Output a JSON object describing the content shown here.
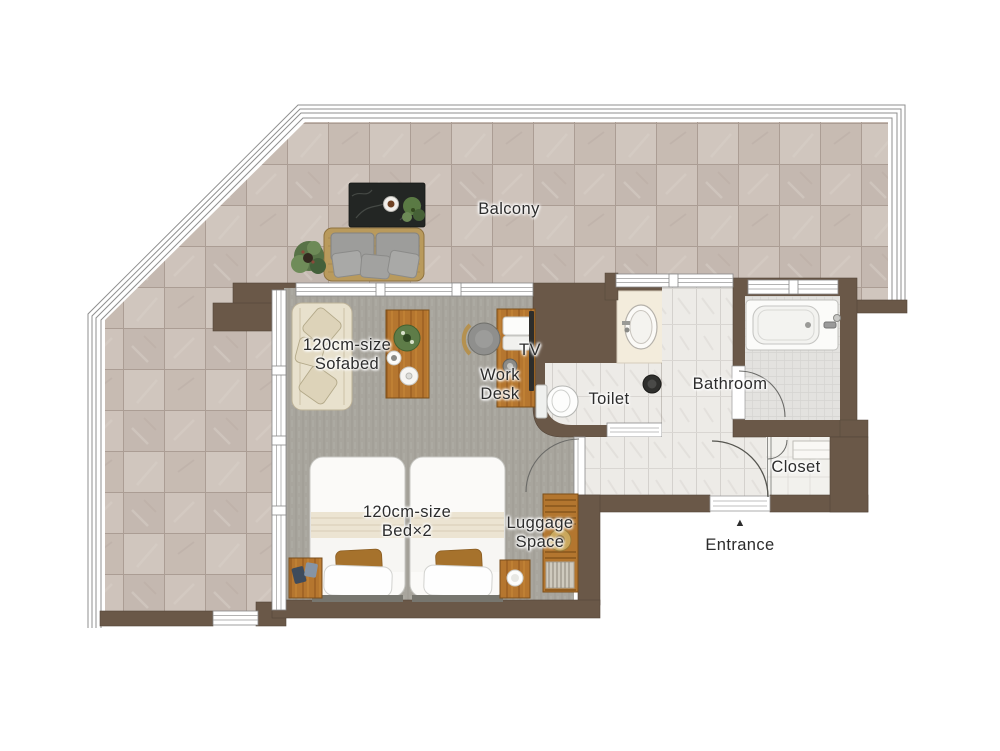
{
  "type": "floor-plan",
  "labels": {
    "balcony": "Balcony",
    "sofabed": "120cm-size\nSofabed",
    "tv": "TV",
    "work_desk": "Work\nDesk",
    "toilet": "Toilet",
    "bathroom": "Bathroom",
    "closet": "Closet",
    "beds": "120cm-size\nBed×2",
    "luggage": "Luggage\nSpace",
    "entrance": "Entrance",
    "entrance_marker": "▲"
  },
  "rooms": [
    "Balcony",
    "Living / Bedroom",
    "Toilet",
    "Bathroom",
    "Closet",
    "Hallway",
    "Entrance"
  ],
  "furniture": [
    "outdoor sofa",
    "outdoor low table",
    "potted plants",
    "120cm sofabed",
    "coffee table",
    "work desk",
    "desk chair",
    "wall TV",
    "bed 1",
    "bed 2",
    "nightstand left",
    "nightstand right",
    "luggage rack",
    "toilet",
    "washbasin",
    "bathtub",
    "trash bin"
  ],
  "colors": {
    "background": "#ffffff",
    "wall": "#6a5848",
    "wall_edge": "#54463a",
    "balcony_tile": "#cabfb7",
    "tile_grout": "#ab9d94",
    "carpet": "#a8a59d",
    "wood": "#b5762f",
    "corridor_tile": "#edebe7",
    "bathroom_floor": "#e3e2df",
    "cushion_gray": "#9d9d9b",
    "bedding_white": "#fbfaf8",
    "accent_pillow": "#a6722c",
    "label_text": "#2c2c2c"
  }
}
